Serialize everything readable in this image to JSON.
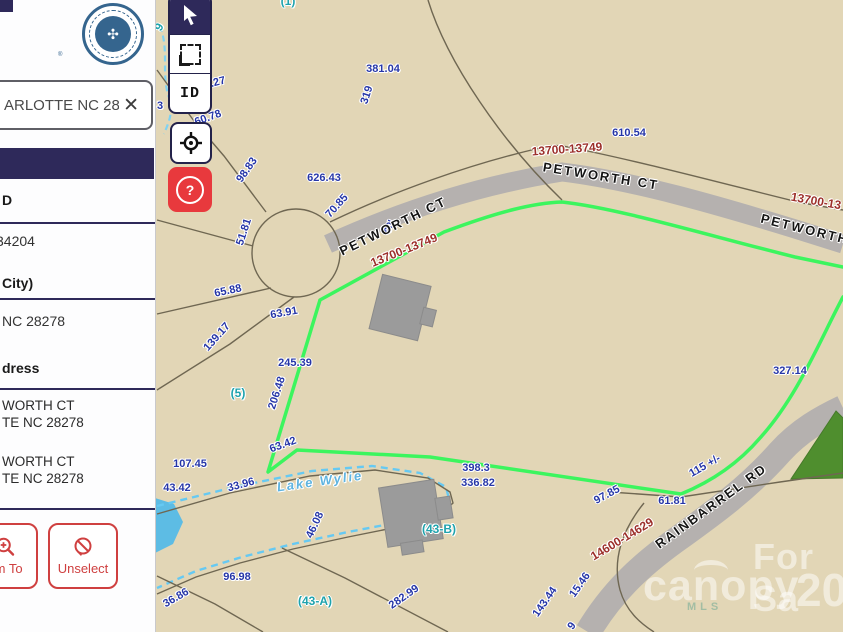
{
  "colors": {
    "map_bg": "#e2d6b6",
    "road": "#b5b1af",
    "parcel_line": "#6f6752",
    "highlight_green": "#3cf55e",
    "dimension_text": "#2636a8",
    "range_text": "#9c2f2a",
    "parcel_id_text": "#1fa3ad",
    "navy": "#2e295a",
    "help_red": "#e8393d",
    "button_red": "#cf4040",
    "water": "#66c9f2",
    "woods": "#4f8e2e"
  },
  "sidebar": {
    "search": {
      "value": "ARLOTTE NC 28",
      "close_glyph": "✕"
    },
    "seal": {
      "registered": "®"
    },
    "fields": [
      {
        "label": "D"
      },
      {
        "value": "34204"
      },
      {
        "label": "City)"
      },
      {
        "value": "NC 28278"
      },
      {
        "label": "dress"
      }
    ],
    "addresses": [
      {
        "lines": [
          "WORTH CT",
          "TE NC 28278"
        ]
      },
      {
        "lines": [
          "WORTH CT",
          "TE NC 28278"
        ]
      }
    ],
    "buttons": {
      "zoom_to": "om To",
      "unselect": "Unselect"
    }
  },
  "toolbar": {
    "id_label": "ID",
    "help_glyph": "?"
  },
  "map": {
    "water_label": "Lake Wylie",
    "labels": [
      {
        "t": "381.04",
        "x": 383,
        "y": 69,
        "r": 0,
        "c": "dim"
      },
      {
        "t": "319",
        "x": 367,
        "y": 95,
        "r": -72,
        "c": "dim"
      },
      {
        "t": "610.54",
        "x": 629,
        "y": 133,
        "r": 0,
        "c": "dim"
      },
      {
        "t": "626.43",
        "x": 324,
        "y": 178,
        "r": 0,
        "c": "dim"
      },
      {
        "t": "70.85",
        "x": 337,
        "y": 206,
        "r": -48,
        "c": "dim"
      },
      {
        "t": "98.83",
        "x": 247,
        "y": 170,
        "r": -55,
        "c": "dim"
      },
      {
        "t": "60.78",
        "x": 208,
        "y": 118,
        "r": -20,
        "c": "dim"
      },
      {
        "t": "4.27",
        "x": 215,
        "y": 83,
        "r": -15,
        "c": "dim"
      },
      {
        "t": "51.81",
        "x": 244,
        "y": 232,
        "r": -72,
        "c": "dim"
      },
      {
        "t": "65.88",
        "x": 228,
        "y": 291,
        "r": -12,
        "c": "dim"
      },
      {
        "t": "63.91",
        "x": 284,
        "y": 313,
        "r": -10,
        "c": "dim"
      },
      {
        "t": "139.17",
        "x": 217,
        "y": 337,
        "r": -48,
        "c": "dim"
      },
      {
        "t": "245.39",
        "x": 295,
        "y": 363,
        "r": 0,
        "c": "dim"
      },
      {
        "t": "206.48",
        "x": 277,
        "y": 393,
        "r": -72,
        "c": "dim"
      },
      {
        "t": "63.42",
        "x": 283,
        "y": 445,
        "r": -20,
        "c": "dim"
      },
      {
        "t": "107.45",
        "x": 190,
        "y": 464,
        "r": 0,
        "c": "dim"
      },
      {
        "t": "43.42",
        "x": 177,
        "y": 488,
        "r": 0,
        "c": "dim"
      },
      {
        "t": "33.96",
        "x": 241,
        "y": 485,
        "r": -15,
        "c": "dim"
      },
      {
        "t": "46.08",
        "x": 315,
        "y": 525,
        "r": -65,
        "c": "dim"
      },
      {
        "t": "96.98",
        "x": 237,
        "y": 577,
        "r": 0,
        "c": "dim"
      },
      {
        "t": "36.86",
        "x": 176,
        "y": 598,
        "r": -30,
        "c": "dim"
      },
      {
        "t": "282.99",
        "x": 404,
        "y": 597,
        "r": -35,
        "c": "dim"
      },
      {
        "t": "398.3",
        "x": 476,
        "y": 468,
        "r": 0,
        "c": "dim"
      },
      {
        "t": "336.82",
        "x": 478,
        "y": 483,
        "r": 0,
        "c": "dim"
      },
      {
        "t": "97.85",
        "x": 607,
        "y": 495,
        "r": -28,
        "c": "dim"
      },
      {
        "t": "61.81",
        "x": 672,
        "y": 501,
        "r": 0,
        "c": "dim"
      },
      {
        "t": "143.44",
        "x": 545,
        "y": 602,
        "r": -55,
        "c": "dim"
      },
      {
        "t": "15.46",
        "x": 580,
        "y": 585,
        "r": -55,
        "c": "dim"
      },
      {
        "t": "327.14",
        "x": 790,
        "y": 371,
        "r": 0,
        "c": "dim"
      },
      {
        "t": "115 +/-",
        "x": 705,
        "y": 466,
        "r": -30,
        "c": "dim"
      },
      {
        "t": "60'",
        "x": 390,
        "y": 227,
        "r": -68,
        "s": 10,
        "c": "dim"
      },
      {
        "t": "3",
        "x": 160,
        "y": 106,
        "r": 0,
        "c": "dim"
      },
      {
        "t": "9",
        "x": 572,
        "y": 626,
        "r": -55,
        "c": "dim"
      },
      {
        "t": "13700-13749",
        "x": 404,
        "y": 250,
        "r": -22,
        "c": "range"
      },
      {
        "t": "13700-13749",
        "x": 567,
        "y": 149,
        "r": -4,
        "c": "range"
      },
      {
        "t": "13700-13",
        "x": 816,
        "y": 201,
        "r": 10,
        "c": "range"
      },
      {
        "t": "14600-14629",
        "x": 622,
        "y": 539,
        "r": -31,
        "c": "range"
      },
      {
        "t": "PETWORTH CT",
        "x": 393,
        "y": 226,
        "r": -26,
        "c": "street"
      },
      {
        "t": "PETWORTH CT",
        "x": 601,
        "y": 176,
        "r": 9,
        "c": "street"
      },
      {
        "t": "PETWORTH",
        "x": 805,
        "y": 229,
        "r": 14,
        "c": "street"
      },
      {
        "t": "RAINBARREL RD",
        "x": 711,
        "y": 506,
        "r": -36,
        "c": "street"
      },
      {
        "t": "(1)",
        "x": 288,
        "y": 1,
        "r": 0,
        "c": "pid"
      },
      {
        "t": "(5)",
        "x": 238,
        "y": 393,
        "r": 0,
        "c": "pid"
      },
      {
        "t": "(43-B)",
        "x": 439,
        "y": 529,
        "r": 0,
        "c": "pid"
      },
      {
        "t": "(43-A)",
        "x": 315,
        "y": 601,
        "r": 0,
        "c": "pid"
      },
      {
        "t": "9",
        "x": 159,
        "y": 27,
        "r": -60,
        "c": "pid"
      },
      {
        "t": "Lake Wylie",
        "x": 320,
        "y": 481,
        "r": -8,
        "c": "water"
      }
    ],
    "watermark": {
      "line1": "For Sa",
      "brand": "canopy",
      "mls": "MLS",
      "year": "20"
    }
  }
}
